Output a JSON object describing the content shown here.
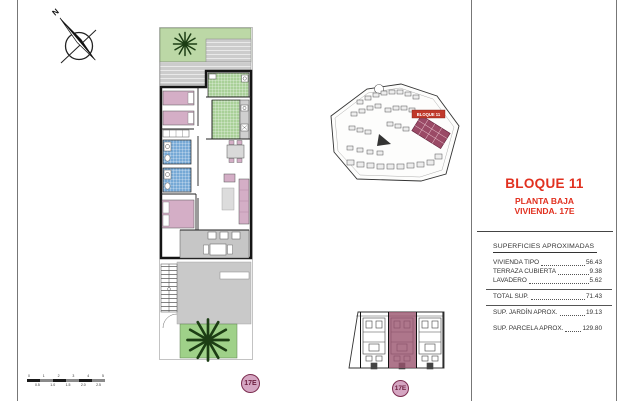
{
  "title_block": {
    "block": "BLOQUE 11",
    "floor": "PLANTA BAJA",
    "unit": "VIVIENDA. 17E",
    "surfaces_header": "SUPERFICIES APROXIMADAS",
    "rows": [
      {
        "label": "VIVIENDA TIPO",
        "value": "56.43"
      },
      {
        "label": "TERRAZA CUBIERTA",
        "value": "9.38"
      },
      {
        "label": "LAVADERO",
        "value": "5.62"
      }
    ],
    "total": {
      "label": "TOTAL SUP.",
      "value": "71.43"
    },
    "extras": [
      {
        "label": "SUP. JARDÍN APROX.",
        "value": "19.13"
      },
      {
        "label": "SUP. PARCELA APROX.",
        "value": "129.80"
      }
    ]
  },
  "floor_plan": {
    "unit_badge": "17E"
  },
  "key_plan": {
    "unit_badge": "17E"
  },
  "site_plan": {
    "block_label": "BLOQUE 11"
  },
  "compass": {
    "north": "N"
  },
  "scale_bar": {
    "top": [
      "0",
      "1",
      "2",
      "3",
      "4",
      "5"
    ],
    "bottom": [
      "0.5",
      "1.0",
      "1.5",
      "2.0",
      "2.5"
    ]
  },
  "colors": {
    "accent_red": "#e1301f",
    "highlight_maroon": "#9a546e",
    "badge_pink": "#d5a6c2",
    "garden_green": "#bcd8a6",
    "bath_blue": "#76a9d6",
    "kitchen_green": "#a9d098",
    "furniture_pink": "#d4aec6",
    "terrace_gray": "#cccccc",
    "wall_black": "#151515"
  }
}
